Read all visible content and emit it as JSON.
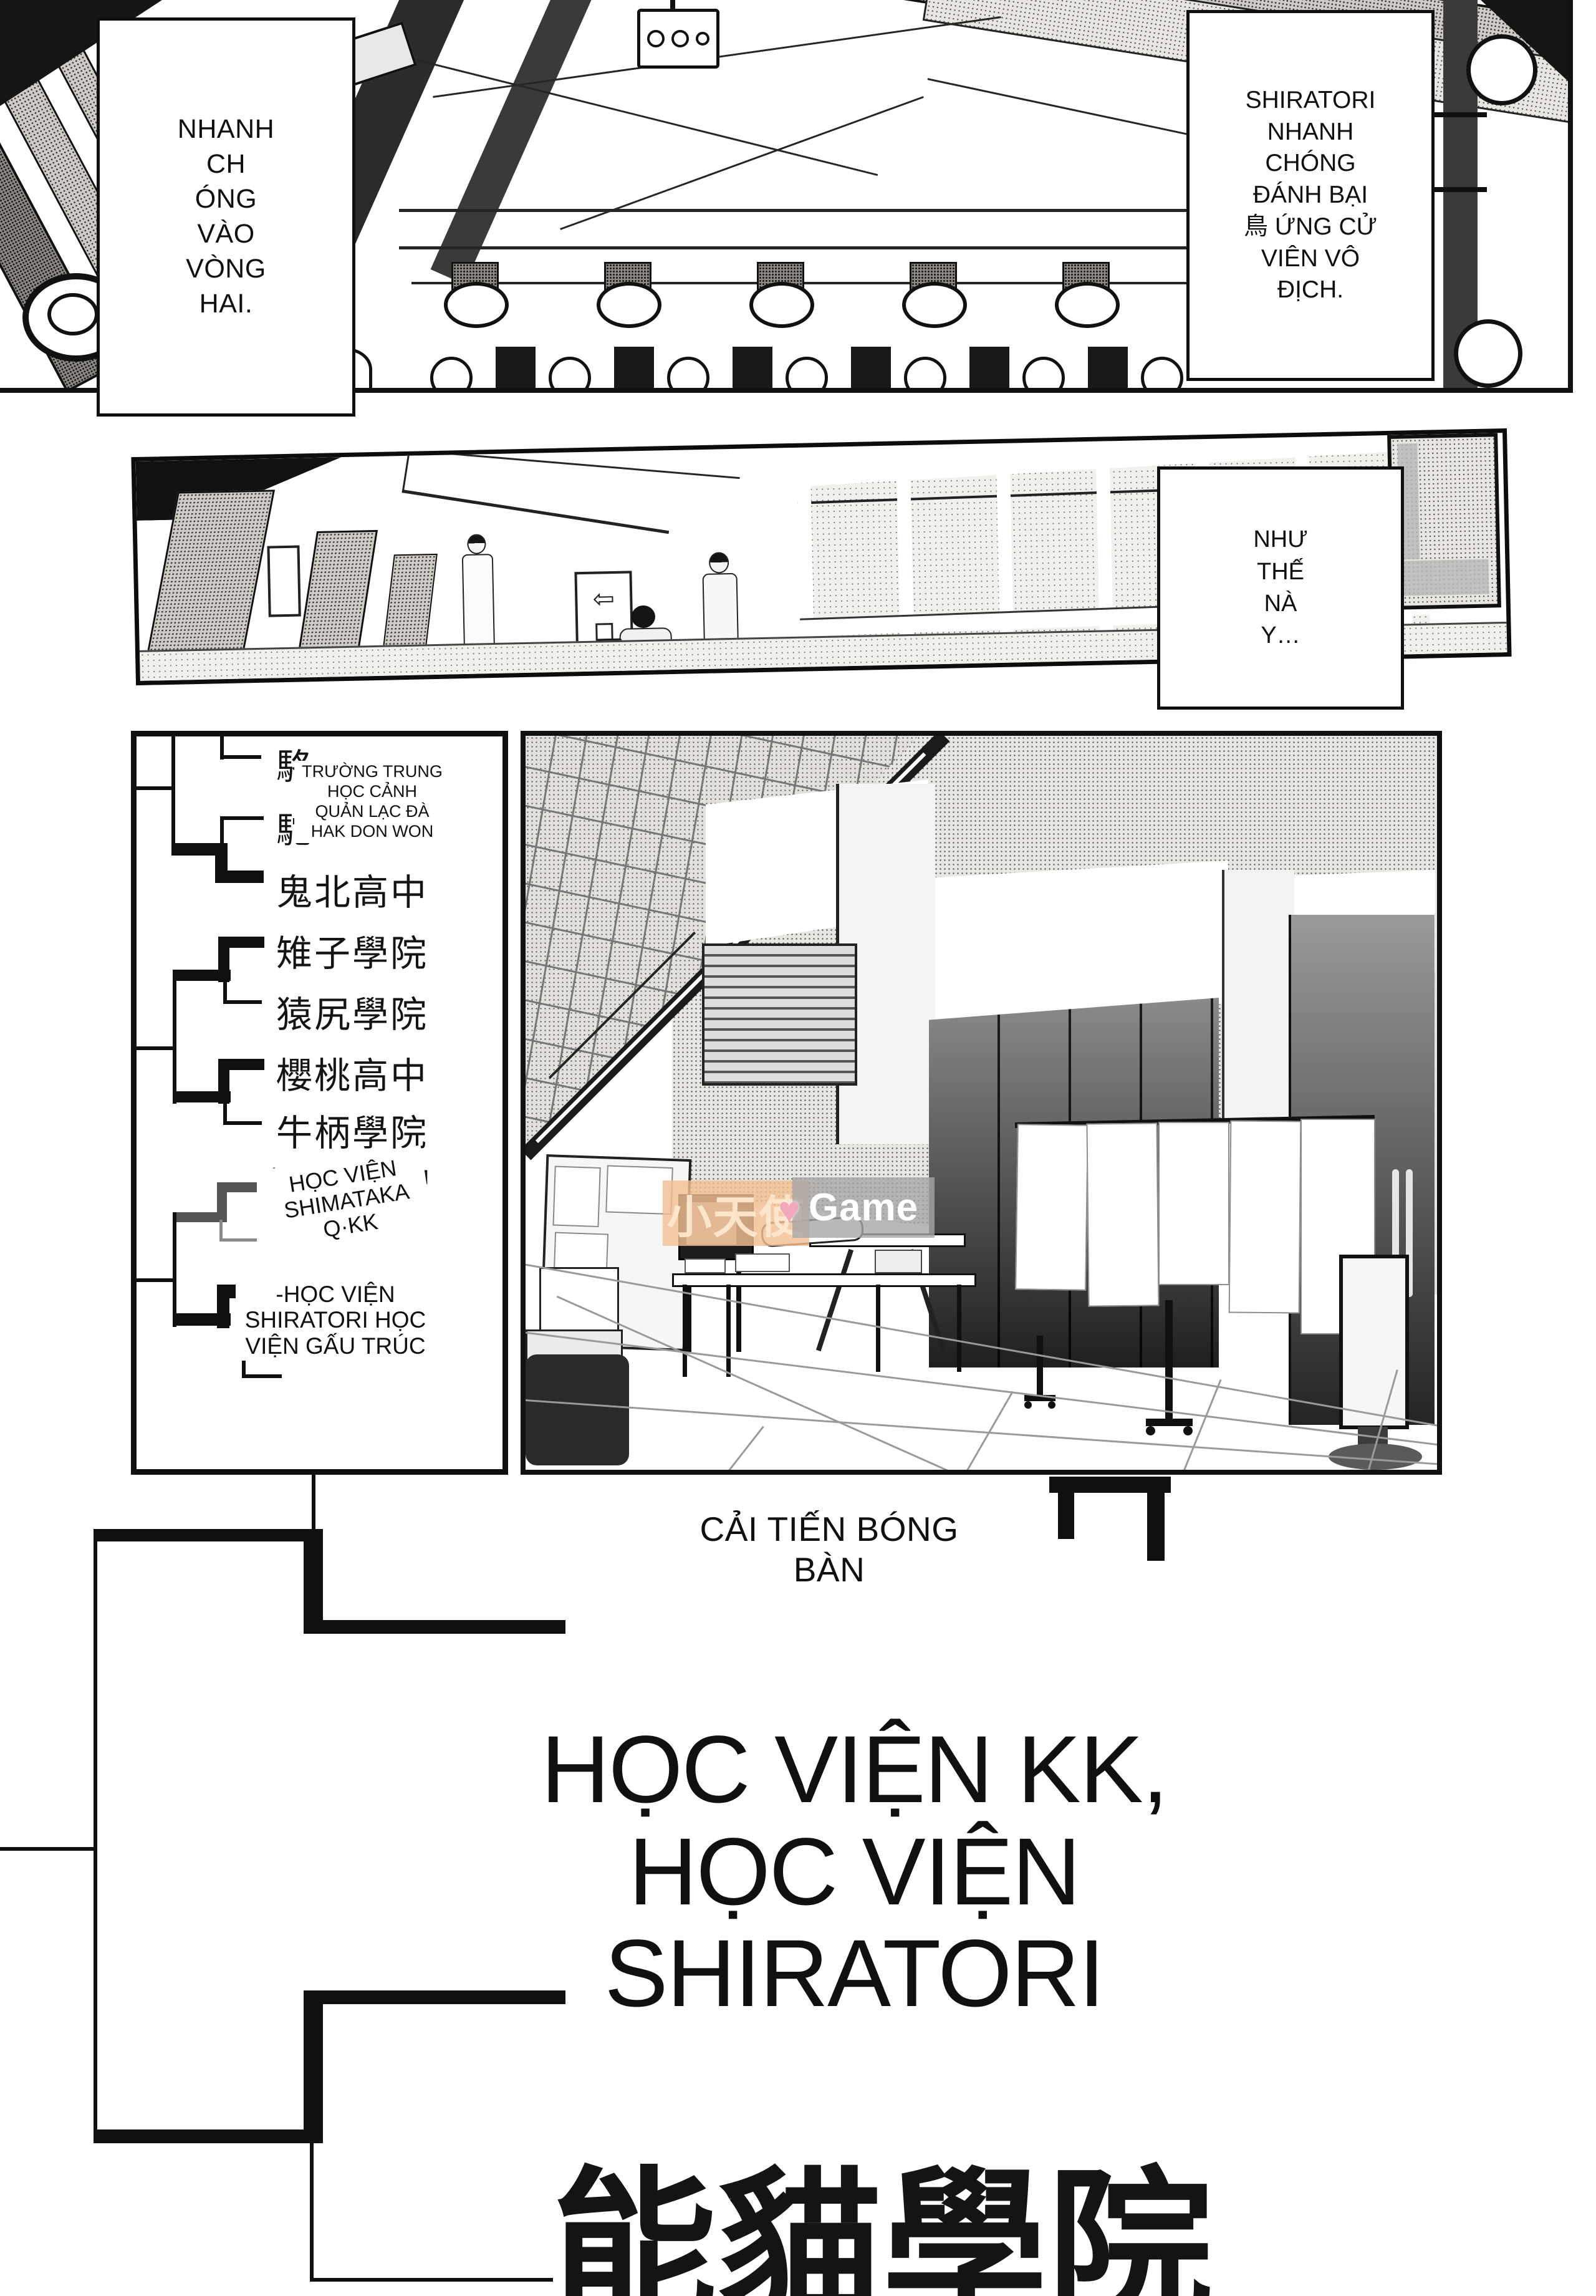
{
  "page": {
    "bg": "#ffffff",
    "ink": "#111111"
  },
  "panel1": {
    "box_left": {
      "text": "NHANH\nCH\nÓNG\nVÀO\nVÒNG\nHAI."
    },
    "box_right": {
      "text": "SHIRATORI\nNHANH\nCHÓNG\nĐÁNH BẠI\n鳥 ỨNG CỬ\nVIÊN VÔ\nĐỊCH."
    }
  },
  "panel2": {
    "box": {
      "text": "NHƯ\nTHẾ\nNÀ\nY…"
    }
  },
  "bracket": {
    "overlay_top": "TRƯỜNG TRUNG\nHỌC CẢNH\nQUẢN LẠC ĐÀ\nHAK DON WON",
    "schools": [
      "駱",
      "駝",
      "鬼北高中",
      "雉子學院",
      "猿尻學院",
      "櫻桃高中",
      "牛柄學院"
    ],
    "fragment_left": "嶋",
    "fragment_right": "中",
    "overlay_shimataka": "HỌC VIỆN\nSHIMATAKA\nQ·KK",
    "overlay_shiratori": "-HỌC VIỆN\nSHIRATORI HỌC\nVIỆN GẤU TRÚC"
  },
  "caption": {
    "text": "CẢI TIẾN BÓNG\nBÀN"
  },
  "title": {
    "text": "HỌC VIỆN KK,\nHỌC VIỆN\nSHIRATORI"
  },
  "bottom_title": {
    "text": "能貓學院"
  },
  "watermark": {
    "cjk": "小天使",
    "heart": "♥",
    "latin": "Game",
    "orange_bg": "#f2bf92",
    "gray_bg": "#a6a6a6",
    "heart_color": "#f2a7ba",
    "text_color": "#ffffff",
    "cjk_color": "#fde7cd"
  }
}
